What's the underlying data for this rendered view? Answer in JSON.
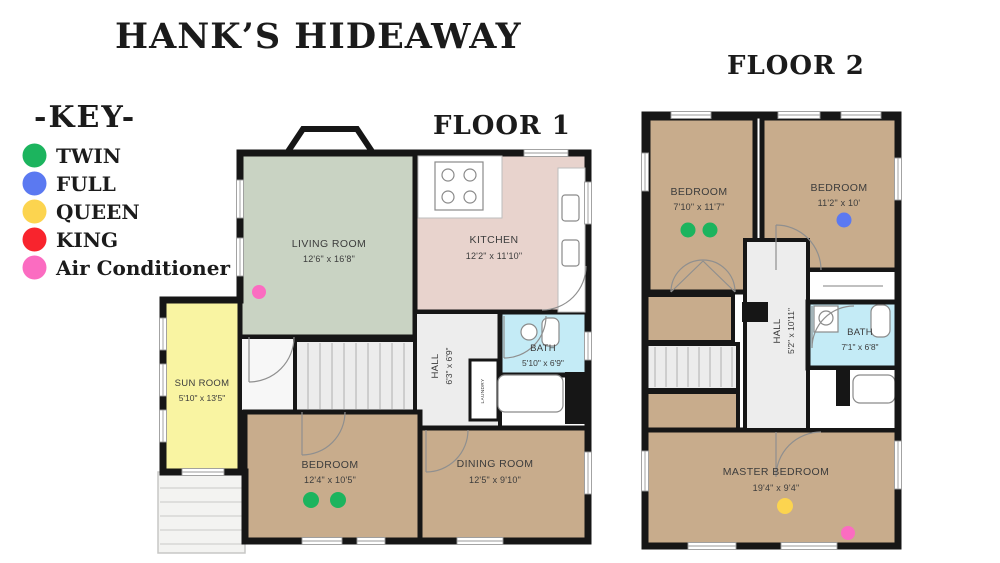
{
  "title": "HANK’S HIDEAWAY",
  "key": {
    "title": "-KEY-",
    "items": [
      {
        "label": "TWIN",
        "color": "#1cb45e"
      },
      {
        "label": "FULL",
        "color": "#5b79f1"
      },
      {
        "label": "QUEEN",
        "color": "#fcd44f"
      },
      {
        "label": "KING",
        "color": "#f8242d"
      },
      {
        "label": "Air Conditioner",
        "color": "#fb6cc1"
      }
    ]
  },
  "colors": {
    "wall": "#161616",
    "living_room": "#c9d3c3",
    "kitchen": "#e8d3cd",
    "bedroom_tan": "#c8ac8c",
    "sun_room": "#f9f4a2",
    "bath": "#c4ebf6",
    "hall": "#ededed",
    "stairs": "#ececec",
    "landing": "#f7f7f7",
    "porch": "#f3f3f1"
  },
  "floor1": {
    "label": "FLOOR 1",
    "living_room": {
      "name": "LIVING ROOM",
      "dims": "12'6\" x 16'8\""
    },
    "kitchen": {
      "name": "KITCHEN",
      "dims": "12'2\" x 11'10\""
    },
    "sun_room": {
      "name": "SUN ROOM",
      "dims": "5'10\" x 13'5\""
    },
    "hall": {
      "name": "HALL",
      "dims": "6'3\" x 6'9\""
    },
    "bath": {
      "name": "BATH",
      "dims": "5'10\" x 6'9\""
    },
    "laundry": {
      "name": "LAUNDRY"
    },
    "bedroom": {
      "name": "BEDROOM",
      "dims": "12'4\" x 10'5\""
    },
    "dining_room": {
      "name": "DINING ROOM",
      "dims": "12'5\" x 9'10\""
    },
    "markers": {
      "living_room": [
        "air-conditioner"
      ],
      "bedroom": [
        "twin",
        "twin"
      ]
    }
  },
  "floor2": {
    "label": "FLOOR 2",
    "bedroom_left": {
      "name": "BEDROOM",
      "dims": "7'10\" x 11'7\""
    },
    "bedroom_right": {
      "name": "BEDROOM",
      "dims": "11'2\" x 10'"
    },
    "hall": {
      "name": "HALL",
      "dims": "5'2\" x 10'11\""
    },
    "bath": {
      "name": "BATH",
      "dims": "7'1\" x 6'8\""
    },
    "master_bedroom": {
      "name": "MASTER BEDROOM",
      "dims": "19'4\" x 9'4\""
    },
    "markers": {
      "bedroom_left": [
        "twin",
        "twin"
      ],
      "bedroom_right": [
        "full"
      ],
      "master_bedroom": [
        "queen",
        "air-conditioner"
      ]
    }
  }
}
